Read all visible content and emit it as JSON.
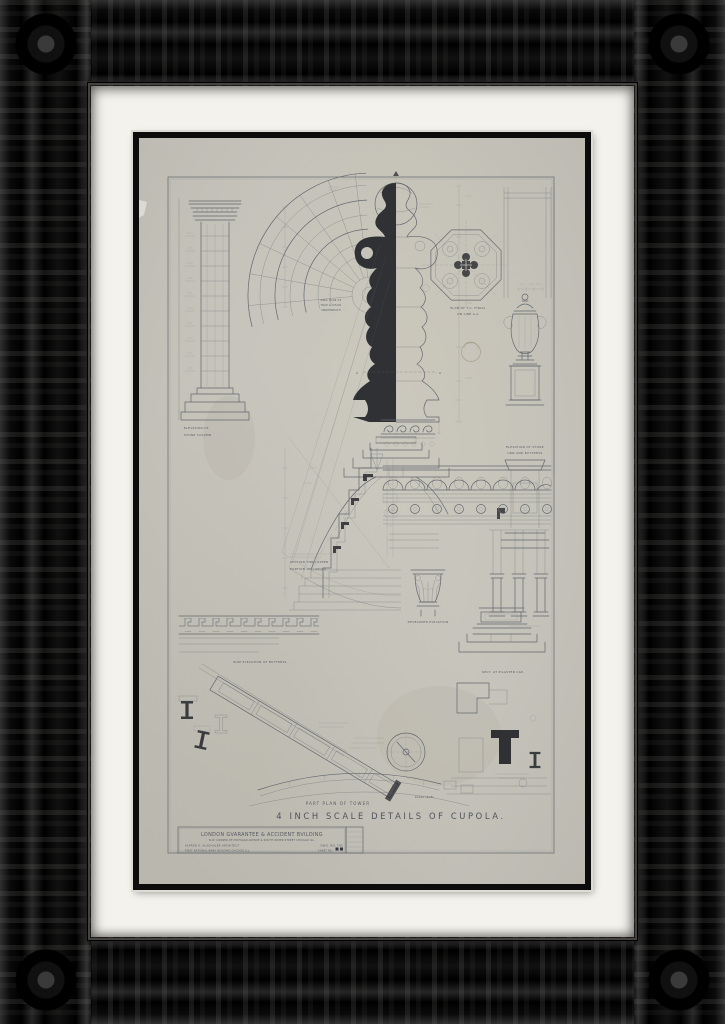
{
  "artwork": {
    "kind": "framed architectural drawing photograph",
    "sheet_title": "4 INCH SCALE DETAILS OF CUPOLA.",
    "labels": {
      "column_l1": "ELEVATION OF",
      "column_l2": "STONE COLUMN",
      "ring_l1": "RING PLAN OF",
      "ring_l2": "TRAP & CHAIR",
      "ring_l3": "UNDERNEATH",
      "finial_plan_l1": "PLAN OF T.C. FINIAL",
      "finial_plan_l2": "ON LINE A-A",
      "urn_l1": "ELEVATION OF STONE",
      "urn_l2": "URN AND BUTTRESS",
      "section_l1": "SECTION THRU UPPER",
      "section_l2": "PORTION OF CUPOLA",
      "developed": "DEVELOPED ELEVATION",
      "buttress": "SIDE ELEVATION OF BUTTRESS",
      "pilaster_cap": "SECT. AT PILASTER CAP.",
      "part_plan": "PART PLAN OF TOWER",
      "plaza": "PLAZA LEVEL",
      "section_mark_left": "A",
      "section_mark_right": "A"
    },
    "title_block": {
      "building": "LONDON GVARANTEE & ACCIDENT BVILDING",
      "address": "N.W. CORNER OF MICHIGAN AVENUE & SOUTH WATER STREET CHICAGO ILL.",
      "architect": "ALFRED S. ALSCHULER ARCHITECT",
      "drawing_no": "DWG. NO. 745",
      "office": "FIRST NATIONAL BANK BUILDING CHICAGO ILL.",
      "sheet_no": "SHEET NO."
    },
    "colors": {
      "paper": "#c6c4bb",
      "pencil": "#5b6069",
      "silhouette": "#23252a",
      "mat": "#f3f2ed",
      "frame": "#0a0a0a",
      "fillet": "#0c0c0c"
    }
  }
}
